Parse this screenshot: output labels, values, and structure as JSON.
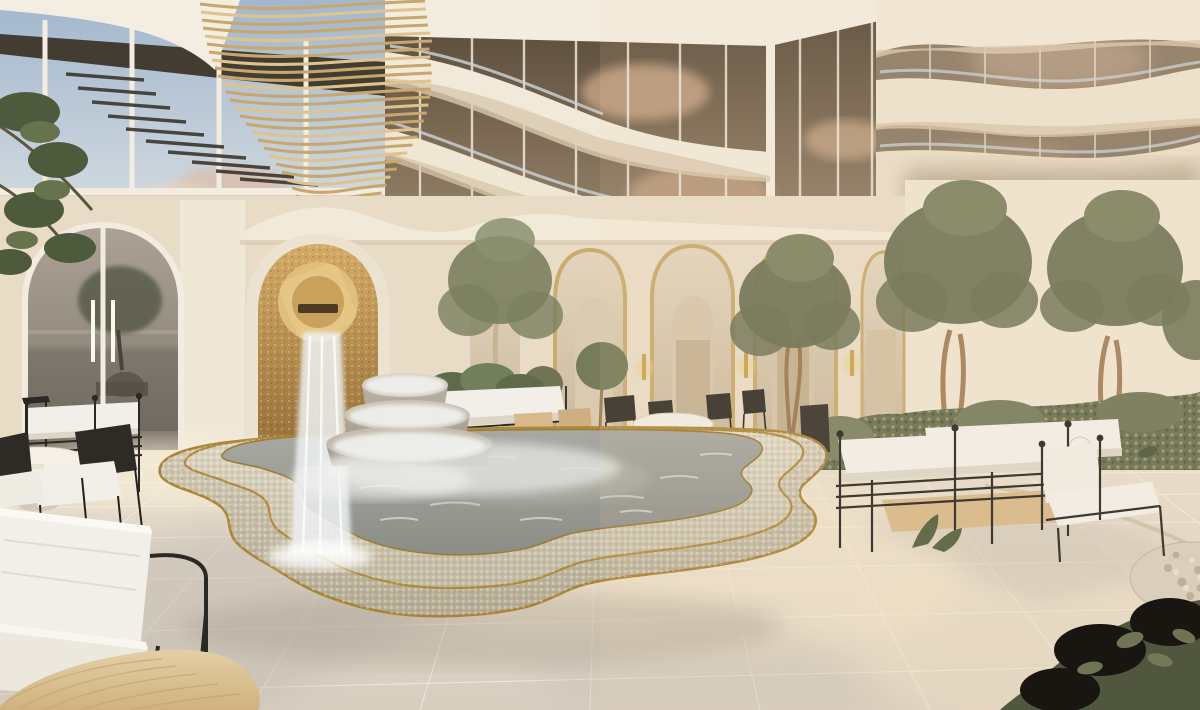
{
  "canvas": {
    "width": 1200,
    "height": 710
  },
  "scene": {
    "title_hidden": "",
    "type": "photorealistic architectural rendering, luxury resort courtyard",
    "lighting": "warm late-afternoon sunlight from the right, soft shadows",
    "objects": [
      {
        "name": "upper-glass-facade-left",
        "desc": "floor-to-ceiling glass wall reflecting blue sky and clouds, white mullions"
      },
      {
        "name": "gold-louver-sculpture",
        "desc": "curved fin sail of thin horizontal gold/wood slats in front of the glass"
      },
      {
        "name": "corner-glass-tower",
        "desc": "dark reflective curtain wall corner with cloud reflections and curved white balcony bands"
      },
      {
        "name": "right-balcony-bands",
        "desc": "three stacked wavy cream balcony slabs with glass railings receding right"
      },
      {
        "name": "arched-glass-door",
        "desc": "left wall arched glass door reflecting a tree, sea horizon and a tiered fountain, white frame and twin handles"
      },
      {
        "name": "fountain-niche",
        "desc": "arched niche with gold mosaic interior and a Moorish octofoil spout"
      },
      {
        "name": "waterfall",
        "desc": "sheet of water falling from the spout into the pool"
      },
      {
        "name": "tiered-fountain",
        "desc": "three stacked round stone bowls covered in cascading white water"
      },
      {
        "name": "mosaic-pool",
        "desc": "large scalloped quatrefoil pool with two stepped mosaic tiers, gold trim lines, grey-blue shimmering water"
      },
      {
        "name": "arcade",
        "desc": "row of tall arches with gold-flecked edges, inner arches, doors and wall sconces"
      },
      {
        "name": "olive-trees",
        "desc": "several potted and planted olive trees with pale twisting trunks"
      },
      {
        "name": "hedge",
        "desc": "low clipped green hedge along the right wall"
      },
      {
        "name": "daybed-group-right",
        "desc": "white cushioned daybeds and armchair with thin black iron rail frames and ball finials"
      },
      {
        "name": "dining-set",
        "desc": "round white table with dark metal chairs under the arcade"
      },
      {
        "name": "sofa-group-left",
        "desc": "white rail sofa, round white table and black-frame lounge chairs near the glass wall"
      },
      {
        "name": "foreground-lounge-chair",
        "desc": "white boucle lounge chair with thin black tube frame, bottom left"
      },
      {
        "name": "wood-table-corner",
        "desc": "light oak tabletop corner entering the frame at bottom left"
      },
      {
        "name": "stone-floor",
        "desc": "large-format travertine pavers with sun patches and cool shadows"
      },
      {
        "name": "pebble-inlay",
        "desc": "curved pebble mosaic border and circle at right edge of paving"
      },
      {
        "name": "dark-foliage-corner",
        "desc": "dark leafy branches entering bottom-right corner"
      }
    ]
  },
  "palette": {
    "base_cream": "#eae0cf",
    "wall_lit": "#f0e7d5",
    "wall_mid": "#e8dcc7",
    "wall_shade": "#d8c8ae",
    "sky_reflection_top": "#a3b7cd",
    "sky_reflection_bottom": "#cfd8dd",
    "dark_glass": "#6a5a48",
    "cloud_tan": "#c8a687",
    "gold_slat": "#c9a76c",
    "gold_slat_bright": "#dfc38c",
    "niche_gold_light": "#cfa660",
    "niche_gold_dark": "#96703a",
    "gold_trim": "#aa8538",
    "water_grey": "#9b9c96",
    "mosaic_light": "#d9d2c0",
    "mosaic_face": "#c3baa5",
    "floor_light": "#e9dfcd",
    "floor_shadow": "#c3bcb2",
    "sun_patch": "#f6e7cb",
    "wood_light": "#e0c9a0",
    "iron_black": "#2c2823",
    "cushion_white": "#f2efe8",
    "olive_green": "#6d7254",
    "olive_dark": "#565c42",
    "trunk_tan": "#a3815a",
    "hedge_green": "#6a7051"
  }
}
